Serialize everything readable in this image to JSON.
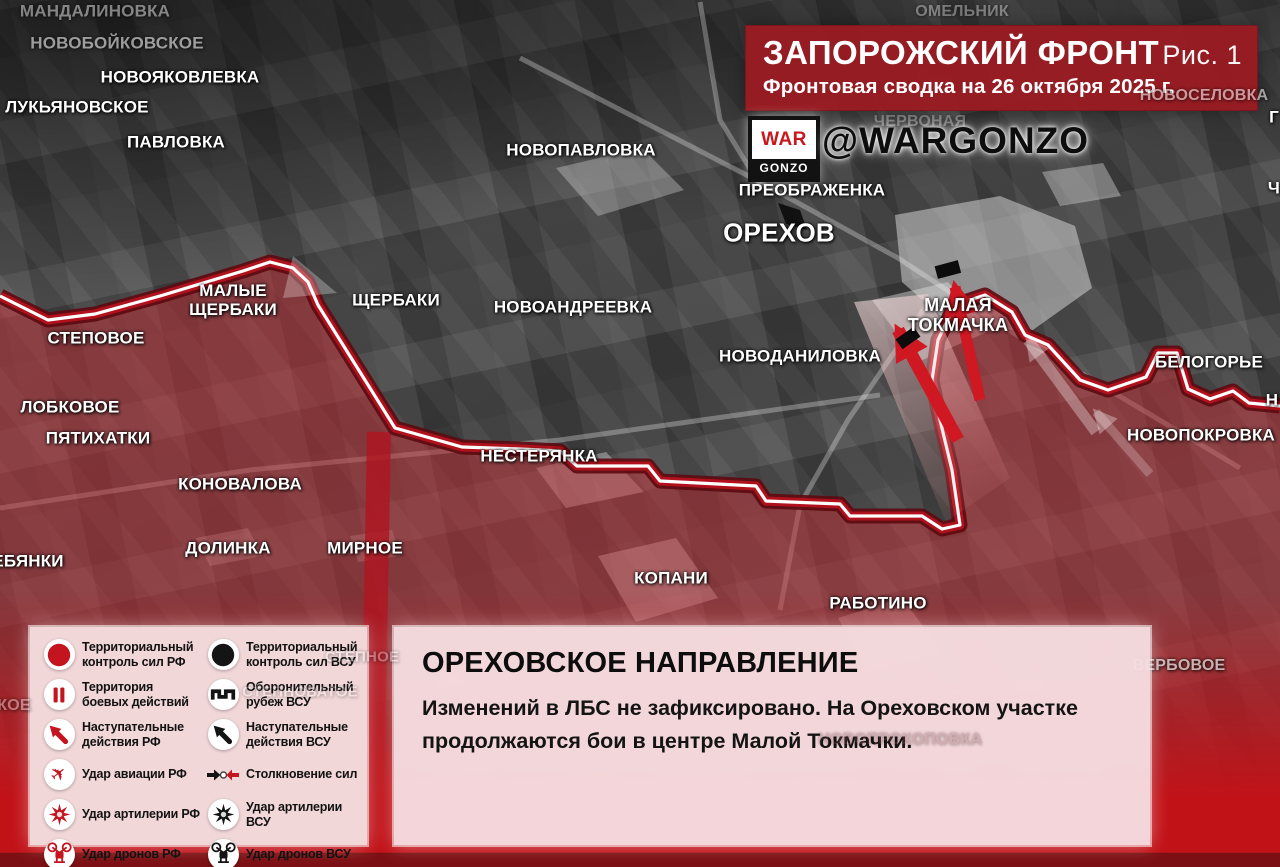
{
  "header": {
    "title": "ЗАПОРОЖСКИЙ ФРОНТ",
    "figure": "Рис. 1",
    "subtitle": "Фронтовая сводка на 26 октября 2025 г.",
    "logo_top": "WAR",
    "logo_bottom": "GONZO",
    "handle": "@WARGONZO"
  },
  "report": {
    "title": "ОРЕХОВСКОЕ НАПРАВЛЕНИЕ",
    "text": "Изменений в ЛБС не зафиксировано. На Ореховском участке продолжаются бои в центре Малой Токмачки."
  },
  "legend": {
    "rows": [
      {
        "left": {
          "icon": "rf-territorial-control",
          "shape": "circle",
          "color": "#c3141f",
          "label": "Территориальный контроль сил РФ"
        },
        "right": {
          "icon": "afu-territorial-control",
          "shape": "circle",
          "color": "#141414",
          "label": "Территориальный контроль сил ВСУ"
        }
      },
      {
        "left": {
          "icon": "combat-zone",
          "shape": "bars",
          "color": "#c3141f",
          "label": "Территория боевых действий"
        },
        "right": {
          "icon": "afu-defense-line",
          "shape": "defense",
          "color": "#141414",
          "label": "Оборонительный рубеж ВСУ"
        }
      },
      {
        "left": {
          "icon": "rf-advance",
          "shape": "advance",
          "color": "#c3141f",
          "label": "Наступательные действия РФ"
        },
        "right": {
          "icon": "afu-advance",
          "shape": "advance",
          "color": "#141414",
          "label": "Наступательные действия ВСУ"
        }
      },
      {
        "left": {
          "icon": "rf-airstrike",
          "shape": "plane",
          "color": "#c3141f",
          "label": "Удар авиации РФ"
        },
        "right": {
          "icon": "forces-clash",
          "shape": "clash",
          "flat": true,
          "label": "Столкновение сил"
        }
      },
      {
        "left": {
          "icon": "rf-artillery",
          "shape": "star",
          "color": "#c3141f",
          "label": "Удар артилерии РФ"
        },
        "right": {
          "icon": "afu-artillery",
          "shape": "star",
          "color": "#141414",
          "label": "Удар артилерии ВСУ"
        }
      },
      {
        "left": {
          "icon": "rf-drones",
          "shape": "drone",
          "color": "#c3141f",
          "label": "Удар дронов РФ"
        },
        "right": {
          "icon": "afu-drones",
          "shape": "drone",
          "color": "#141414",
          "label": "Удар дронов ВСУ"
        }
      }
    ]
  },
  "map": {
    "labels": [
      {
        "text": "МАНДАЛИНОВКА",
        "x": 95,
        "y": 11,
        "size": 17,
        "opacity": 0.45
      },
      {
        "text": "НОВОБОЙКОВСКОЕ",
        "x": 117,
        "y": 43,
        "size": 17,
        "opacity": 0.55
      },
      {
        "text": "НОВОЯКОВЛЕВКА",
        "x": 180,
        "y": 77,
        "size": 17
      },
      {
        "text": "ЛУКЬЯНОВСКОЕ",
        "x": 77,
        "y": 107,
        "size": 17
      },
      {
        "text": "ПАВЛОВКА",
        "x": 176,
        "y": 142,
        "size": 17
      },
      {
        "text": "НОВОПАВЛОВКА",
        "x": 581,
        "y": 150,
        "size": 17
      },
      {
        "text": "ОМЕЛЬНИК",
        "x": 962,
        "y": 12,
        "size": 16,
        "opacity": 0.35
      },
      {
        "text": "НОВОСЕЛОВКА",
        "x": 1204,
        "y": 96,
        "size": 16,
        "opacity": 0.55,
        "layer": "top"
      },
      {
        "text": "ЧЕРВОНАЯ",
        "x": 920,
        "y": 122,
        "size": 16,
        "opacity": 0.3
      },
      {
        "text": "ПРЕОБРАЖЕНКА",
        "x": 812,
        "y": 190,
        "size": 17
      },
      {
        "text": "ОРЕХОВ",
        "x": 779,
        "y": 233,
        "size": 26
      },
      {
        "text": "МАЛЫЕ\nЩЕРБАКИ",
        "x": 233,
        "y": 300,
        "size": 17
      },
      {
        "text": "ЩЕРБАКИ",
        "x": 396,
        "y": 300,
        "size": 17
      },
      {
        "text": "НОВОАНДРЕЕВКА",
        "x": 573,
        "y": 307,
        "size": 17
      },
      {
        "text": "СТЕПОВОЕ",
        "x": 96,
        "y": 338,
        "size": 17
      },
      {
        "text": "МАЛАЯ\nТОКМАЧКА",
        "x": 958,
        "y": 315,
        "size": 18
      },
      {
        "text": "НОВОДАНИЛОВКА",
        "x": 800,
        "y": 356,
        "size": 17
      },
      {
        "text": "БЕЛОГОРЬЕ",
        "x": 1209,
        "y": 362,
        "size": 17
      },
      {
        "text": "ЛОБКОВОЕ",
        "x": 70,
        "y": 407,
        "size": 17
      },
      {
        "text": "ПЯТИХАТКИ",
        "x": 98,
        "y": 438,
        "size": 17
      },
      {
        "text": "ЕБЯНКИ",
        "x": 28,
        "y": 561,
        "size": 17
      },
      {
        "text": "НОВОПОКРОВКА",
        "x": 1201,
        "y": 435,
        "size": 17
      },
      {
        "text": "КОНОВАЛОВА",
        "x": 240,
        "y": 484,
        "size": 17
      },
      {
        "text": "НЕСТЕРЯНКА",
        "x": 539,
        "y": 456,
        "size": 17
      },
      {
        "text": "ДОЛИНКА",
        "x": 228,
        "y": 548,
        "size": 17
      },
      {
        "text": "МИРНОЕ",
        "x": 365,
        "y": 548,
        "size": 17
      },
      {
        "text": "КОПАНИ",
        "x": 671,
        "y": 578,
        "size": 17
      },
      {
        "text": "РАБОТИНО",
        "x": 878,
        "y": 603,
        "size": 17
      },
      {
        "text": "ВЕРБОВОЕ",
        "x": 1179,
        "y": 666,
        "size": 16,
        "opacity": 0.8,
        "color": "#d8d2d2"
      },
      {
        "text": "СТЕПНОЕ",
        "x": 362,
        "y": 658,
        "size": 15,
        "opacity": 0.32,
        "layer": "top"
      },
      {
        "text": "СТЕПНОВАТОЕ",
        "x": 300,
        "y": 693,
        "size": 15,
        "opacity": 0.26,
        "layer": "top"
      },
      {
        "text": "НОВОПРОКОПОВКА",
        "x": 900,
        "y": 740,
        "size": 16,
        "opacity": 0.3,
        "color": "#8a5057",
        "layer": "top"
      },
      {
        "text": "КОЕ",
        "x": 14,
        "y": 706,
        "size": 16,
        "opacity": 0.5,
        "layer": "top",
        "color": "#eec6ca"
      },
      {
        "text": "Г",
        "x": 1274,
        "y": 117,
        "size": 17
      },
      {
        "text": "Ч",
        "x": 1274,
        "y": 188,
        "size": 17
      },
      {
        "text": "Н",
        "x": 1272,
        "y": 400,
        "size": 17
      }
    ]
  },
  "colors": {
    "title_band": "#9a1b22",
    "accent_red": "#c3141f",
    "front_line_red": "#b5121d",
    "front_line_dark": "#5c0a10",
    "panel_pink": "#f2d7d9",
    "info_pink": "#f6dee1",
    "bottom_red": "#c11218"
  }
}
